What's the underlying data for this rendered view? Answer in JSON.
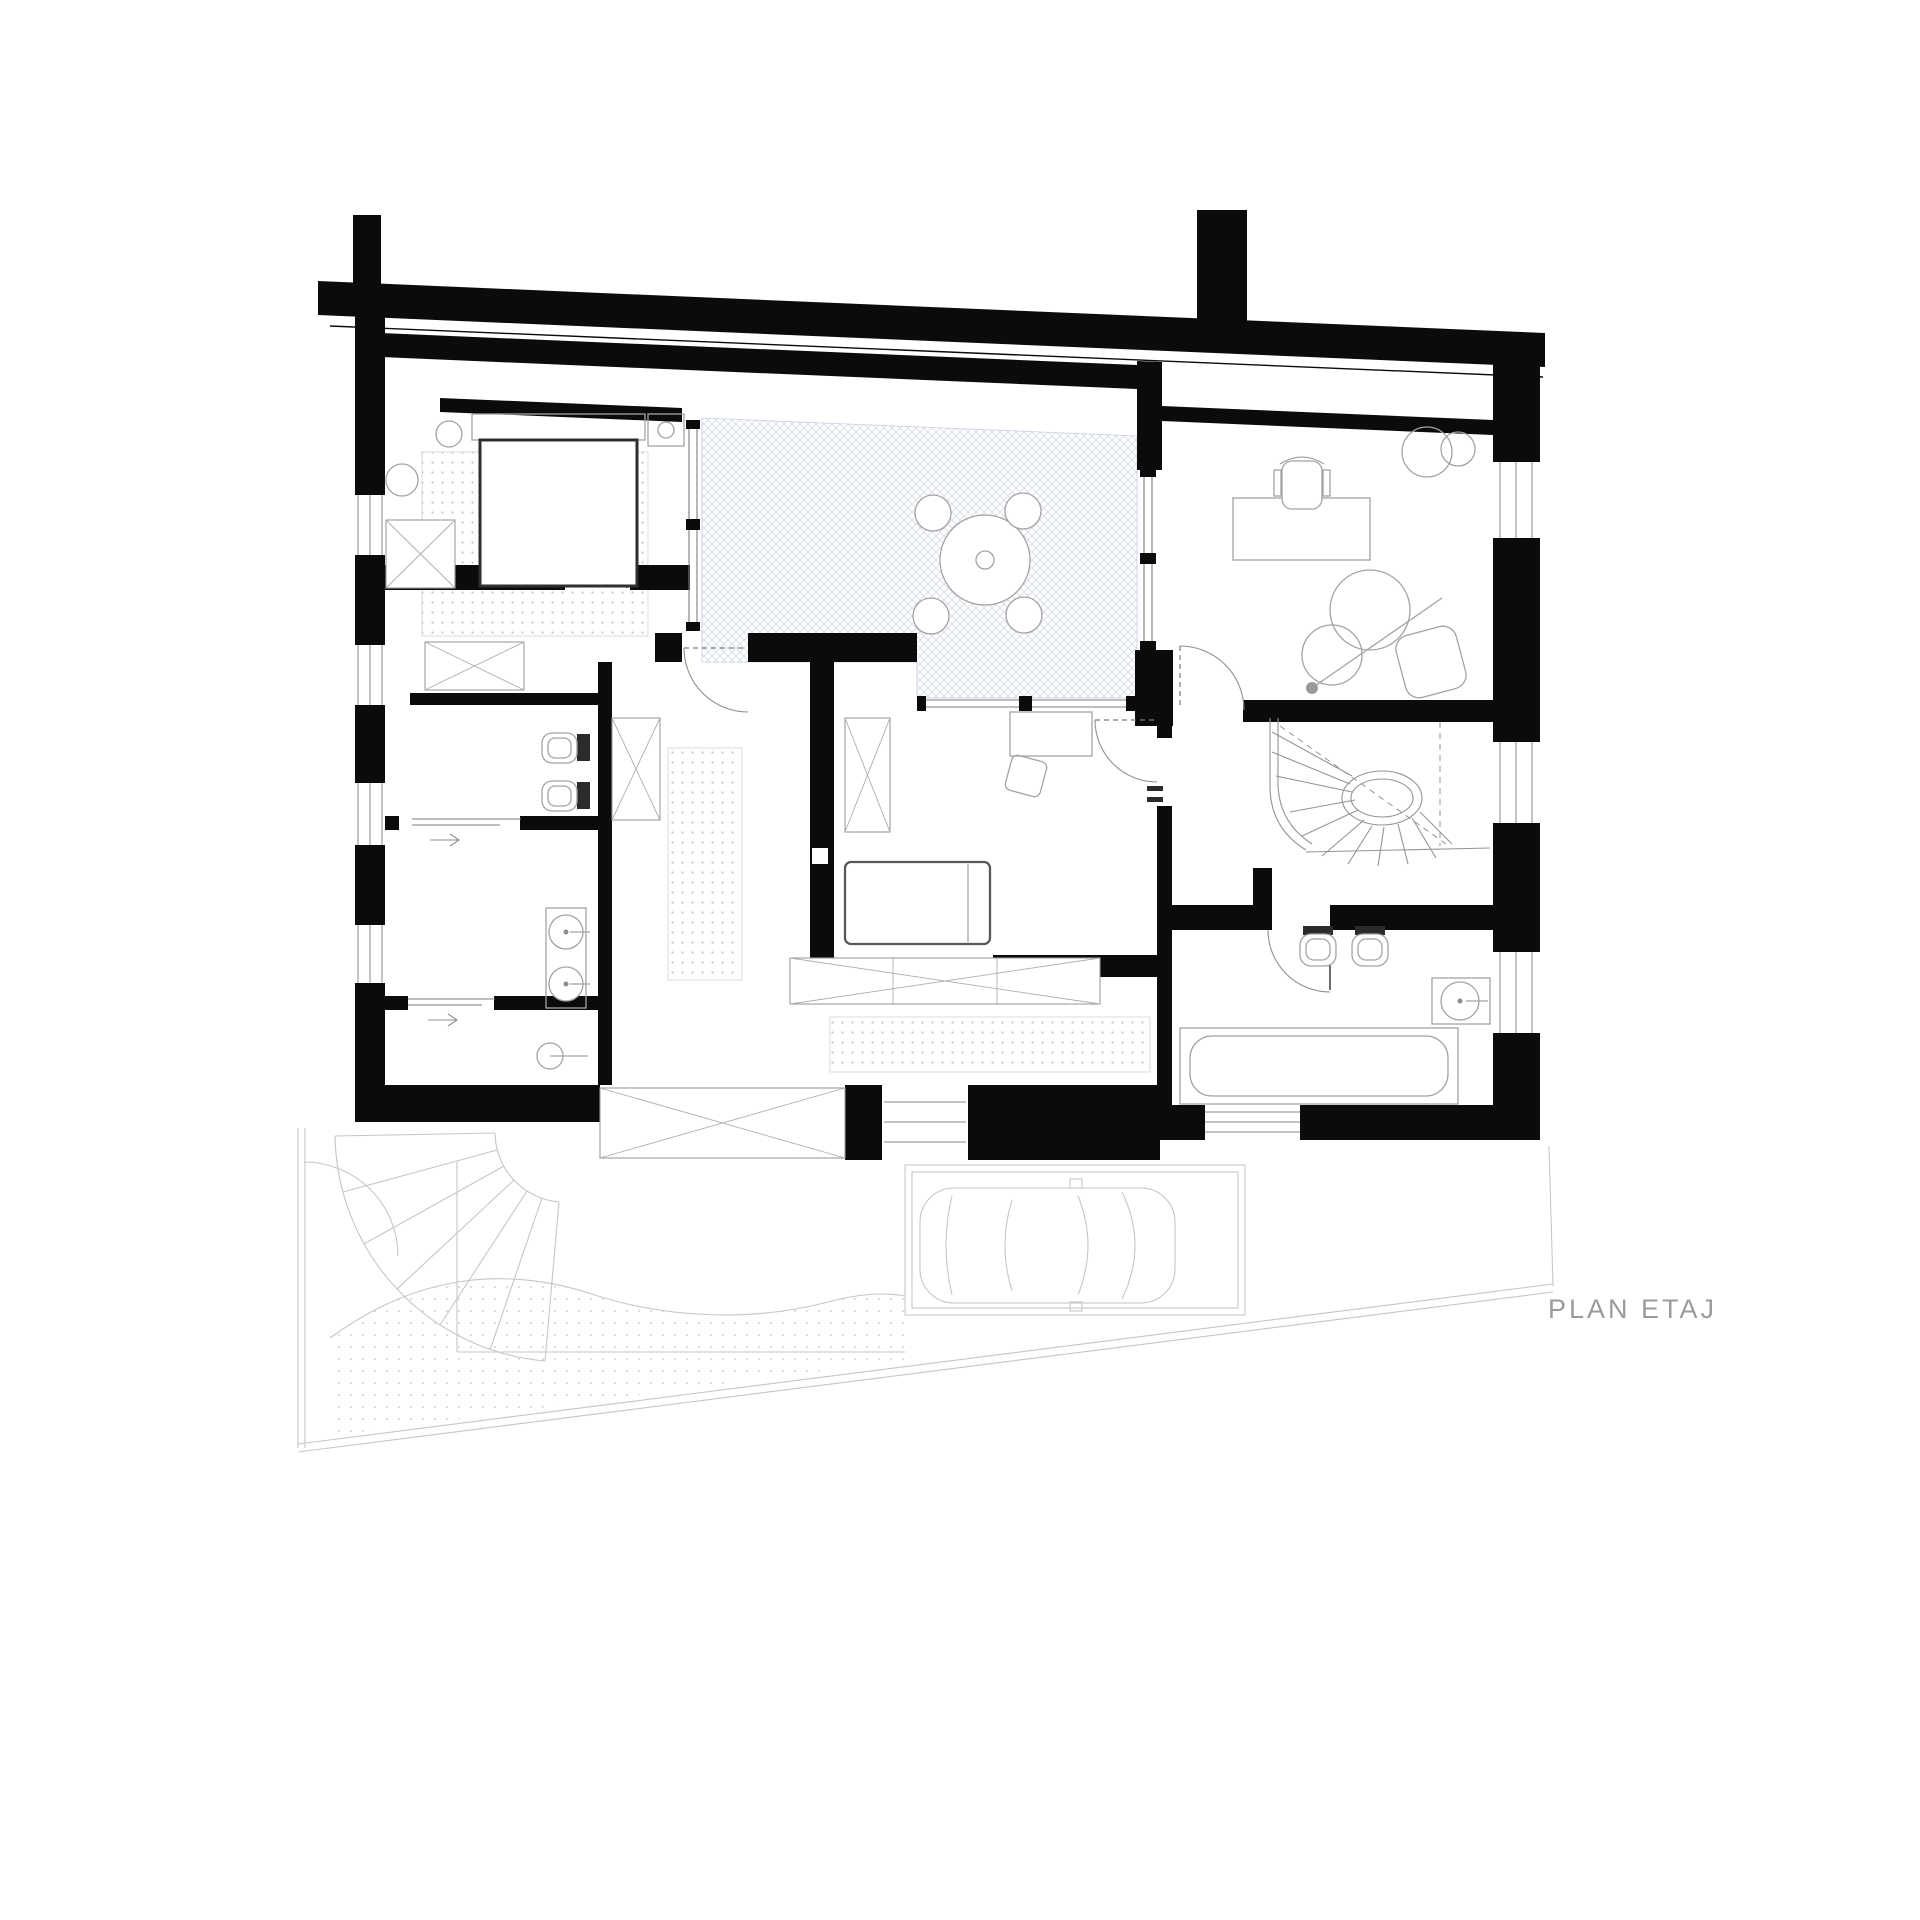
{
  "title": {
    "label": "PLAN ETAJ"
  },
  "colors": {
    "background": "#ffffff",
    "wall": "#0b0b0b",
    "furniture_line": "#a3a3a3",
    "bold_line": "#2e2e2e",
    "terrace_hatch": "#ccd3e2",
    "rug_dot": "#c3c6d2",
    "ghost_line": "#c6c6c6",
    "ghost_stipple": "#d2d2d2",
    "title_text": "#9b9b9b"
  },
  "plan_features": [
    "double-bed",
    "nightstand",
    "bedside-lamp",
    "plant",
    "wardrobe-closets",
    "terrace-crosshatch",
    "round-table",
    "stools",
    "office-desk",
    "office-chair",
    "lounge-chairs",
    "floor-lamp",
    "plants",
    "corridor-runner-rug",
    "dressing-closet-row",
    "single-bed",
    "study-desk",
    "desk-chair",
    "wc",
    "bidet",
    "double-washbasin",
    "shower",
    "sliding-doors",
    "winder-staircase",
    "bathtub",
    "washbasin",
    "ghost-ground-floor",
    "exterior-curved-stair",
    "site-boundary",
    "garage",
    "car"
  ]
}
